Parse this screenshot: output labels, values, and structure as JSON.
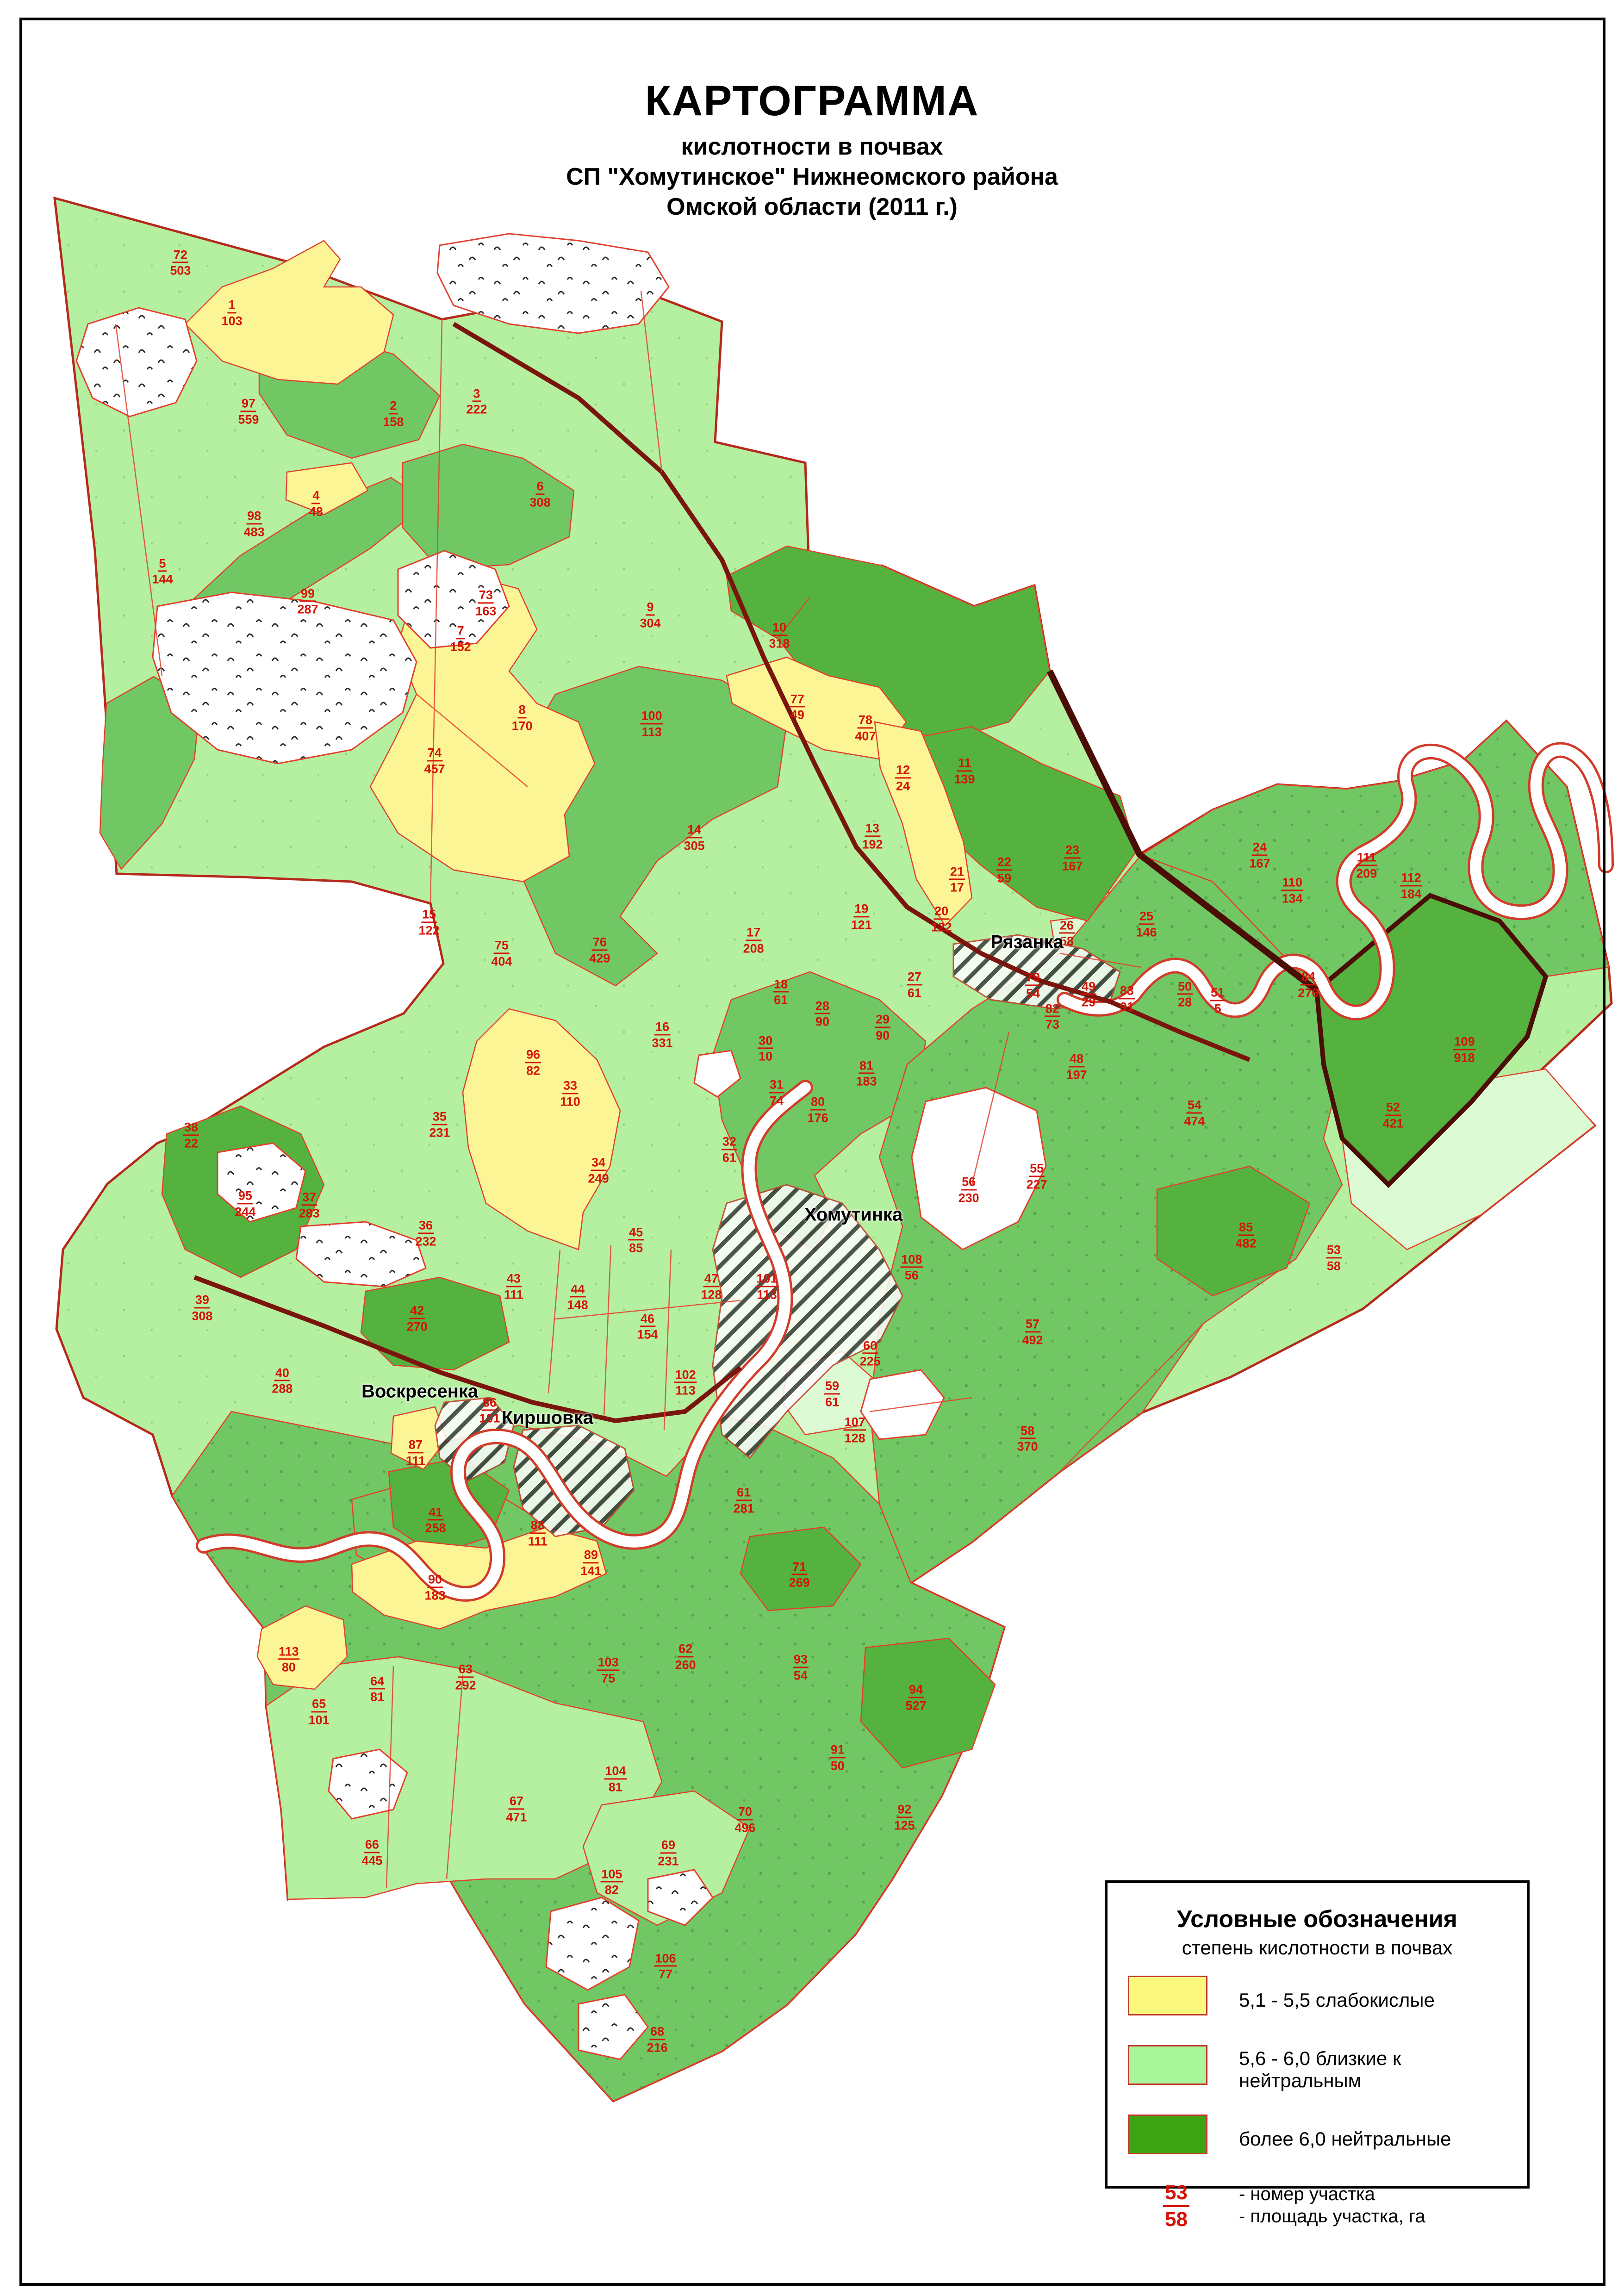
{
  "title": {
    "line1": "КАРТОГРАММА",
    "line2": "кислотности в почвах",
    "line3": "СП \"Хомутинское\" Нижнеомского района",
    "line4": "Омской области (2011 г.)"
  },
  "legend": {
    "heading": "Условные обозначения",
    "subheading": "степень кислотности в почвах",
    "items": [
      {
        "label": "5,1 - 5,5 слабокислые",
        "color": "#fcf87e"
      },
      {
        "label": "5,6 - 6,0 близкие к нейтральным",
        "color": "#a9f69b"
      },
      {
        "label": "более 6,0 нейтральные",
        "color": "#3da313"
      }
    ],
    "example": {
      "number": "53",
      "area": "58",
      "number_label": "- номер участка",
      "area_label": "- площадь участка, га"
    }
  },
  "map": {
    "towns": [
      {
        "name": "Рязанка",
        "x": 63.24,
        "y": 41.06
      },
      {
        "name": "Хомутинка",
        "x": 52.55,
        "y": 52.93
      },
      {
        "name": "Воскресенка",
        "x": 25.85,
        "y": 60.64
      },
      {
        "name": "Киршовка",
        "x": 33.71,
        "y": 61.79
      }
    ],
    "parcels": [
      {
        "n": "1",
        "a": "103",
        "x": 14.28,
        "y": 13.63
      },
      {
        "n": "2",
        "a": "158",
        "x": 24.22,
        "y": 18.03
      },
      {
        "n": "3",
        "a": "222",
        "x": 29.35,
        "y": 17.5
      },
      {
        "n": "4",
        "a": "48",
        "x": 19.46,
        "y": 21.94
      },
      {
        "n": "5",
        "a": "144",
        "x": 10.0,
        "y": 24.9
      },
      {
        "n": "6",
        "a": "308",
        "x": 33.26,
        "y": 21.54
      },
      {
        "n": "7",
        "a": "152",
        "x": 28.36,
        "y": 27.83
      },
      {
        "n": "8",
        "a": "170",
        "x": 32.15,
        "y": 31.28
      },
      {
        "n": "9",
        "a": "304",
        "x": 40.04,
        "y": 26.8
      },
      {
        "n": "10",
        "a": "318",
        "x": 47.99,
        "y": 27.69
      },
      {
        "n": "11",
        "a": "139",
        "x": 59.39,
        "y": 33.6
      },
      {
        "n": "12",
        "a": "24",
        "x": 55.6,
        "y": 33.9
      },
      {
        "n": "13",
        "a": "192",
        "x": 53.72,
        "y": 36.44
      },
      {
        "n": "14",
        "a": "305",
        "x": 42.75,
        "y": 36.5
      },
      {
        "n": "15",
        "a": "122",
        "x": 26.42,
        "y": 40.19
      },
      {
        "n": "16",
        "a": "331",
        "x": 40.78,
        "y": 45.09
      },
      {
        "n": "17",
        "a": "208",
        "x": 46.4,
        "y": 40.98
      },
      {
        "n": "18",
        "a": "61",
        "x": 48.08,
        "y": 43.23
      },
      {
        "n": "19",
        "a": "121",
        "x": 53.04,
        "y": 39.95
      },
      {
        "n": "20",
        "a": "122",
        "x": 57.97,
        "y": 40.05
      },
      {
        "n": "21",
        "a": "17",
        "x": 58.93,
        "y": 38.33
      },
      {
        "n": "22",
        "a": "59",
        "x": 61.84,
        "y": 37.91
      },
      {
        "n": "23",
        "a": "167",
        "x": 66.03,
        "y": 37.39
      },
      {
        "n": "24",
        "a": "167",
        "x": 77.57,
        "y": 37.27
      },
      {
        "n": "25",
        "a": "146",
        "x": 70.59,
        "y": 40.27
      },
      {
        "n": "26",
        "a": "58",
        "x": 65.69,
        "y": 40.67
      },
      {
        "n": "27",
        "a": "61",
        "x": 56.31,
        "y": 42.91
      },
      {
        "n": "28",
        "a": "90",
        "x": 50.64,
        "y": 44.18
      },
      {
        "n": "29",
        "a": "90",
        "x": 54.35,
        "y": 44.77
      },
      {
        "n": "30",
        "a": "10",
        "x": 47.14,
        "y": 45.69
      },
      {
        "n": "31",
        "a": "74",
        "x": 47.82,
        "y": 47.61
      },
      {
        "n": "32",
        "a": "61",
        "x": 44.91,
        "y": 50.09
      },
      {
        "n": "33",
        "a": "110",
        "x": 35.11,
        "y": 47.65
      },
      {
        "n": "34",
        "a": "249",
        "x": 36.85,
        "y": 51.0
      },
      {
        "n": "35",
        "a": "231",
        "x": 27.07,
        "y": 49.0
      },
      {
        "n": "36",
        "a": "232",
        "x": 26.22,
        "y": 53.74
      },
      {
        "n": "37",
        "a": "283",
        "x": 19.04,
        "y": 52.51
      },
      {
        "n": "38",
        "a": "22",
        "x": 11.77,
        "y": 49.47
      },
      {
        "n": "39",
        "a": "308",
        "x": 12.45,
        "y": 56.99
      },
      {
        "n": "40",
        "a": "288",
        "x": 17.38,
        "y": 60.17
      },
      {
        "n": "41",
        "a": "258",
        "x": 26.82,
        "y": 66.24
      },
      {
        "n": "42",
        "a": "270",
        "x": 25.68,
        "y": 57.45
      },
      {
        "n": "43",
        "a": "111",
        "x": 31.63,
        "y": 56.06
      },
      {
        "n": "44",
        "a": "148",
        "x": 35.57,
        "y": 56.52
      },
      {
        "n": "45",
        "a": "85",
        "x": 39.16,
        "y": 54.04
      },
      {
        "n": "46",
        "a": "154",
        "x": 39.87,
        "y": 57.81
      },
      {
        "n": "47",
        "a": "128",
        "x": 43.8,
        "y": 56.06
      },
      {
        "n": "48",
        "a": "197",
        "x": 66.29,
        "y": 46.48
      },
      {
        "n": "49",
        "a": "29",
        "x": 67.03,
        "y": 43.33
      },
      {
        "n": "50",
        "a": "28",
        "x": 72.96,
        "y": 43.33
      },
      {
        "n": "51",
        "a": "5",
        "x": 74.98,
        "y": 43.6
      },
      {
        "n": "52",
        "a": "421",
        "x": 85.78,
        "y": 48.6
      },
      {
        "n": "53",
        "a": "58",
        "x": 82.13,
        "y": 54.81
      },
      {
        "n": "54",
        "a": "474",
        "x": 73.55,
        "y": 48.5
      },
      {
        "n": "55",
        "a": "227",
        "x": 63.84,
        "y": 51.26
      },
      {
        "n": "56",
        "a": "230",
        "x": 59.65,
        "y": 51.85
      },
      {
        "n": "57",
        "a": "492",
        "x": 63.58,
        "y": 58.04
      },
      {
        "n": "58",
        "a": "370",
        "x": 63.27,
        "y": 62.69
      },
      {
        "n": "59",
        "a": "61",
        "x": 51.24,
        "y": 60.74
      },
      {
        "n": "60",
        "a": "225",
        "x": 53.58,
        "y": 58.98
      },
      {
        "n": "61",
        "a": "281",
        "x": 45.8,
        "y": 65.38
      },
      {
        "n": "62",
        "a": "260",
        "x": 42.21,
        "y": 72.19
      },
      {
        "n": "63",
        "a": "292",
        "x": 28.67,
        "y": 73.08
      },
      {
        "n": "64",
        "a": "81",
        "x": 23.23,
        "y": 73.6
      },
      {
        "n": "65",
        "a": "101",
        "x": 19.64,
        "y": 74.59
      },
      {
        "n": "66",
        "a": "445",
        "x": 22.91,
        "y": 80.72
      },
      {
        "n": "67",
        "a": "471",
        "x": 31.8,
        "y": 78.83
      },
      {
        "n": "68",
        "a": "216",
        "x": 40.47,
        "y": 88.87
      },
      {
        "n": "69",
        "a": "231",
        "x": 41.15,
        "y": 80.74
      },
      {
        "n": "70",
        "a": "496",
        "x": 45.88,
        "y": 79.29
      },
      {
        "n": "71",
        "a": "269",
        "x": 49.22,
        "y": 68.62
      },
      {
        "n": "72",
        "a": "503",
        "x": 11.11,
        "y": 11.45
      },
      {
        "n": "73",
        "a": "163",
        "x": 29.92,
        "y": 26.28
      },
      {
        "n": "74",
        "a": "457",
        "x": 26.76,
        "y": 33.15
      },
      {
        "n": "75",
        "a": "404",
        "x": 30.89,
        "y": 41.54
      },
      {
        "n": "76",
        "a": "429",
        "x": 36.93,
        "y": 41.4
      },
      {
        "n": "77",
        "a": "49",
        "x": 49.1,
        "y": 30.81
      },
      {
        "n": "78",
        "a": "407",
        "x": 53.29,
        "y": 31.72
      },
      {
        "n": "79",
        "a": "54",
        "x": 63.61,
        "y": 42.93
      },
      {
        "n": "80",
        "a": "176",
        "x": 50.36,
        "y": 48.36
      },
      {
        "n": "81",
        "a": "183",
        "x": 53.35,
        "y": 46.78
      },
      {
        "n": "82",
        "a": "73",
        "x": 64.8,
        "y": 44.3
      },
      {
        "n": "83",
        "a": "91",
        "x": 69.39,
        "y": 43.52
      },
      {
        "n": "84",
        "a": "276",
        "x": 80.56,
        "y": 42.91
      },
      {
        "n": "85",
        "a": "482",
        "x": 76.72,
        "y": 53.82
      },
      {
        "n": "86",
        "a": "101",
        "x": 30.15,
        "y": 61.46
      },
      {
        "n": "87",
        "a": "111",
        "x": 25.59,
        "y": 63.3
      },
      {
        "n": "88",
        "a": "111",
        "x": 33.11,
        "y": 66.81
      },
      {
        "n": "89",
        "a": "141",
        "x": 36.39,
        "y": 68.1
      },
      {
        "n": "90",
        "a": "183",
        "x": 26.79,
        "y": 69.17
      },
      {
        "n": "91",
        "a": "50",
        "x": 51.58,
        "y": 76.59
      },
      {
        "n": "92",
        "a": "125",
        "x": 55.69,
        "y": 79.19
      },
      {
        "n": "93",
        "a": "54",
        "x": 49.3,
        "y": 72.66
      },
      {
        "n": "94",
        "a": "527",
        "x": 56.4,
        "y": 73.97
      },
      {
        "n": "95",
        "a": "244",
        "x": 15.1,
        "y": 52.45
      },
      {
        "n": "96",
        "a": "82",
        "x": 32.83,
        "y": 46.3
      },
      {
        "n": "97",
        "a": "559",
        "x": 15.3,
        "y": 17.93
      },
      {
        "n": "98",
        "a": "483",
        "x": 15.65,
        "y": 22.83
      },
      {
        "n": "99",
        "a": "287",
        "x": 18.95,
        "y": 26.21
      },
      {
        "n": "100",
        "a": "113",
        "x": 40.13,
        "y": 31.54
      },
      {
        "n": "101",
        "a": "113",
        "x": 47.22,
        "y": 56.06
      },
      {
        "n": "102",
        "a": "113",
        "x": 42.21,
        "y": 60.25
      },
      {
        "n": "103",
        "a": "75",
        "x": 37.45,
        "y": 72.78
      },
      {
        "n": "104",
        "a": "81",
        "x": 37.9,
        "y": 77.52
      },
      {
        "n": "105",
        "a": "82",
        "x": 37.67,
        "y": 82.01
      },
      {
        "n": "106",
        "a": "77",
        "x": 40.98,
        "y": 85.68
      },
      {
        "n": "107",
        "a": "128",
        "x": 52.64,
        "y": 62.31
      },
      {
        "n": "108",
        "a": "56",
        "x": 56.14,
        "y": 55.23
      },
      {
        "n": "109",
        "a": "918",
        "x": 90.17,
        "y": 45.74
      },
      {
        "n": "110",
        "a": "134",
        "x": 79.57,
        "y": 38.8
      },
      {
        "n": "111",
        "a": "209",
        "x": 84.15,
        "y": 37.71
      },
      {
        "n": "112",
        "a": "184",
        "x": 86.89,
        "y": 38.6
      },
      {
        "n": "113",
        "a": "80",
        "x": 17.78,
        "y": 72.31
      }
    ]
  }
}
